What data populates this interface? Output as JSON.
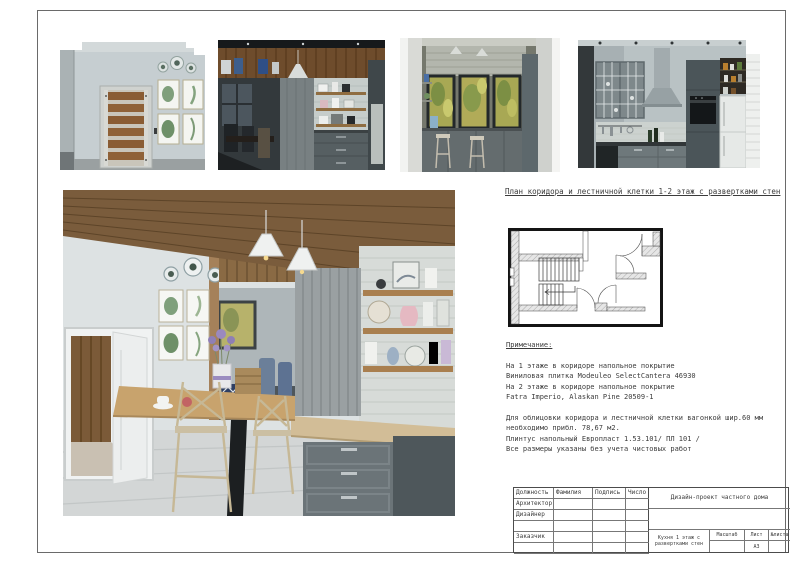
{
  "colors": {
    "paper": "#ffffff",
    "line": "#4c4c4c",
    "text": "#3b3b3b",
    "wood": "#8a6a44",
    "cabinet_gray": "#6b7478"
  },
  "plan_section": {
    "title": "План коридора и лестничной клетки 1-2 этаж с развертками стен"
  },
  "notes": {
    "heading": "Примечание:",
    "para1": [
      "На 1 этаже в коридоре напольное покрытие",
      "Виниловая плитка Modeuleo SelectCantera 46930",
      "На 2 этаже в коридоре напольное покрытие",
      "Fatra Imperio, Alaskan Pine 20509-1"
    ],
    "para2": [
      "Для облицовки коридора и лестничной клетки вагонкой шир.60 мм",
      "необходимо прибл. 78,67 м2.",
      "Плинтус напольный Европласт 1.53.101/ ПЛ 101 /",
      "Все размеры указаны без учета чистовых работ"
    ]
  },
  "titleblock": {
    "headers": {
      "role": "Должность",
      "name": "Фамилия",
      "signature": "Подпись",
      "date": "Число"
    },
    "roles": [
      "Архитектор",
      "Дизайнер",
      "",
      "Заказчик",
      ""
    ],
    "project": "Дизайн-проект частного дома",
    "drawing_title": "Кухня 1 этаж с развертками стен",
    "scale_label": "Масштаб",
    "sheet_label": "Лист",
    "sheet_no_label": "№листа",
    "format": "А3"
  }
}
